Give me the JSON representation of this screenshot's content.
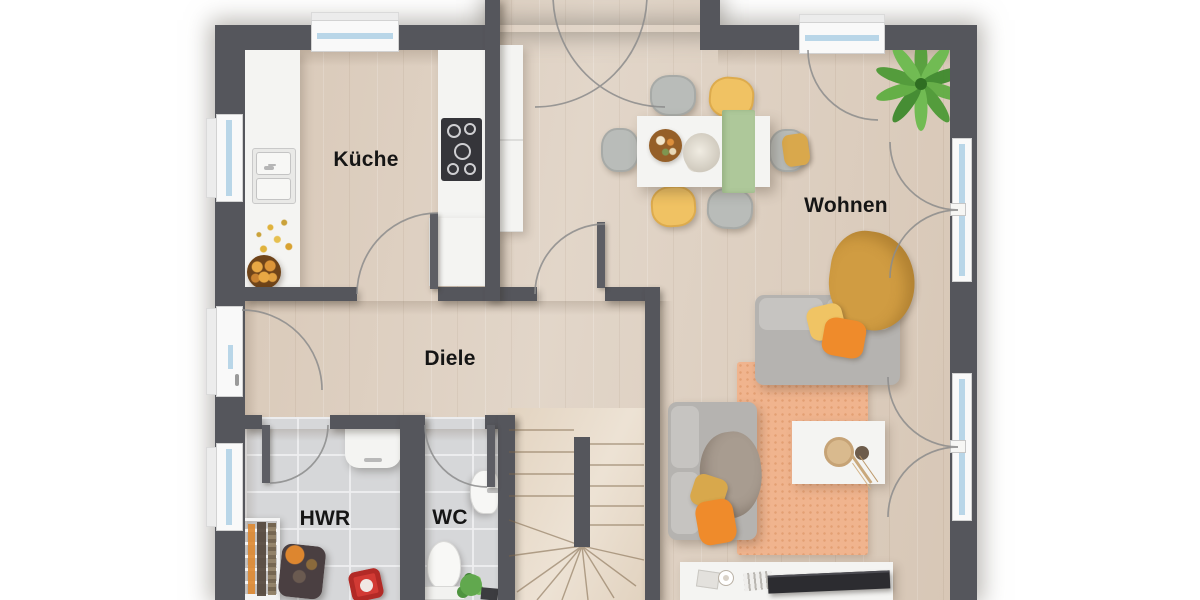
{
  "plan": {
    "type": "residential-floor-plan-top-view",
    "rooms": {
      "kitchen": {
        "label": "Küche"
      },
      "living": {
        "label": "Wohnen"
      },
      "hall": {
        "label": "Diele"
      },
      "utility": {
        "label": "HWR"
      },
      "wc": {
        "label": "WC"
      }
    },
    "palette": {
      "wall": "#55565c",
      "wood_floor": "#ddcfc0",
      "stairs_wood": "#e9dccb",
      "tile_floor": "#d6d7d9",
      "window_glass": "#b9d6e8",
      "rug": "#f0b48e",
      "sofa_gray": "#b5b3b0",
      "accent_orange": "#ef8b2b",
      "accent_yellow": "#f0c263",
      "accent_mustard": "#d09c42",
      "accent_green": "#aec89a",
      "plant_green": "#5da23e"
    }
  }
}
